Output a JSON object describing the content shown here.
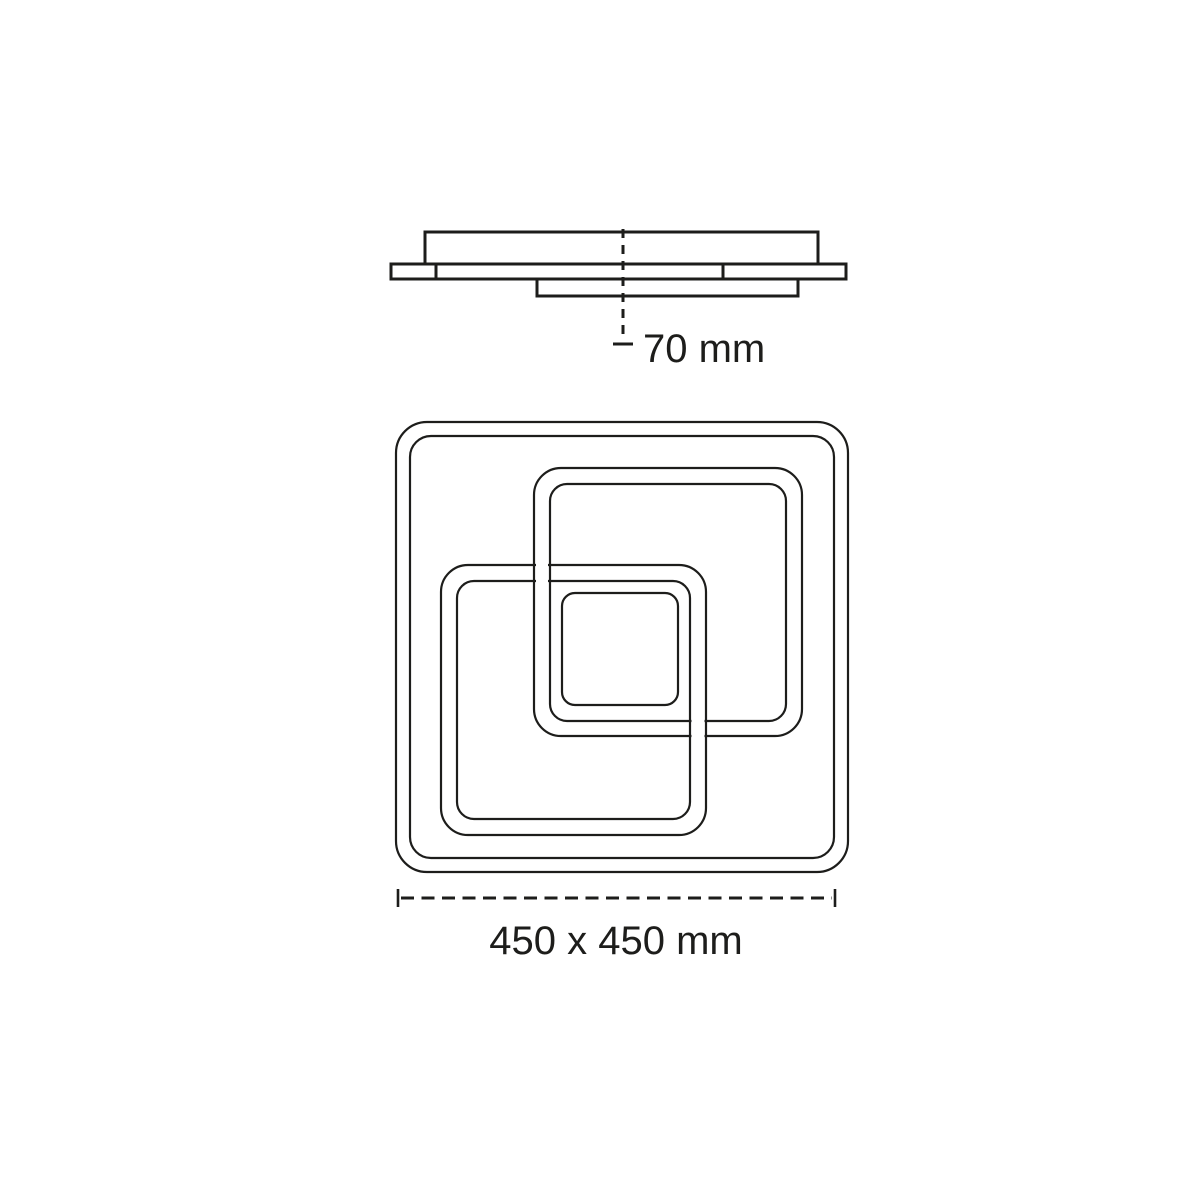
{
  "drawing": {
    "background_color": "#ffffff",
    "line_color": "#1d1d1b",
    "side_view": {
      "height_label": "70 mm"
    },
    "front_view": {
      "size_label": "450 x 450 mm"
    }
  }
}
